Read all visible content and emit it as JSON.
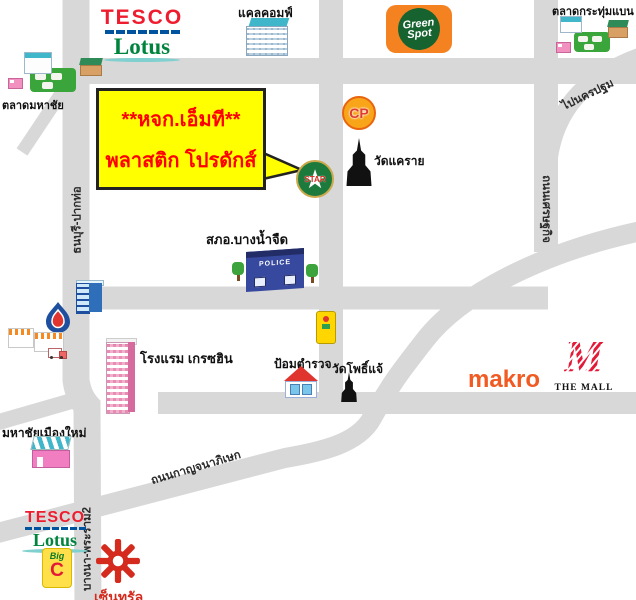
{
  "colors": {
    "road": "#d8d8d8",
    "callout_bg": "#ffff00",
    "callout_text": "#ff0000",
    "tesco_red": "#ee1c2e",
    "tesco_blue": "#00539f",
    "lotus_green": "#00843d",
    "greenspot_orange": "#f58220",
    "greenspot_green": "#17632f",
    "cp_orange": "#f9a51a",
    "cp_red": "#e03c31",
    "makro_orange": "#f15a22",
    "mall_red": "#e31937",
    "central_red": "#d42b1e",
    "star_green": "#1d7a3d",
    "police_blue": "#37499e"
  },
  "callout": {
    "line1": "**หจก.เอ็มที**",
    "line2": "พลาสติก โปรดักส์"
  },
  "roads": {
    "thonburi_paktho": "ธนบุรี-ปากท่อ",
    "setthakit": "ถนนเศรษฐกิจ",
    "to_nakhon_pathom": "ไปนครปฐม",
    "kanchanaphisek": "ถนนกาญจนาภิเษก",
    "rama2": "บางนา-พระราม2"
  },
  "landmarks": {
    "tesco_lotus_top": {
      "line1": "TESCO",
      "line2": "Lotus"
    },
    "calcomp": "แคลคอมฟ์",
    "green_spot": {
      "line1": "Green",
      "line2": "Spot"
    },
    "talat_krathum_baen": "ตลาดกระทุ่มแบน",
    "talat_mahachai": "ตลาดมหาชัย",
    "cp": "CP",
    "wat_khae_rai": "วัดแคราย",
    "star": "STAR",
    "star_glyph": "★",
    "police_station": "สภอ.บางน้ำจืด",
    "police_sign": "POLICE",
    "hotel": "โรงแรม เกรซฮิน",
    "police_box": "ป้อมตำรวจ",
    "wat_pho_chae": "วัดโพธิ์แจ้",
    "makro": "makro",
    "the_mall_m": "M",
    "the_mall": "THE MALL",
    "mahachai_new_town": "มหาชัยเมืองใหม่",
    "tesco_lotus_bottom": {
      "line1": "TESCO",
      "line2": "Lotus"
    },
    "big_c": {
      "line1": "Big",
      "line2": "C"
    },
    "central": "เซ็นทรัล"
  }
}
